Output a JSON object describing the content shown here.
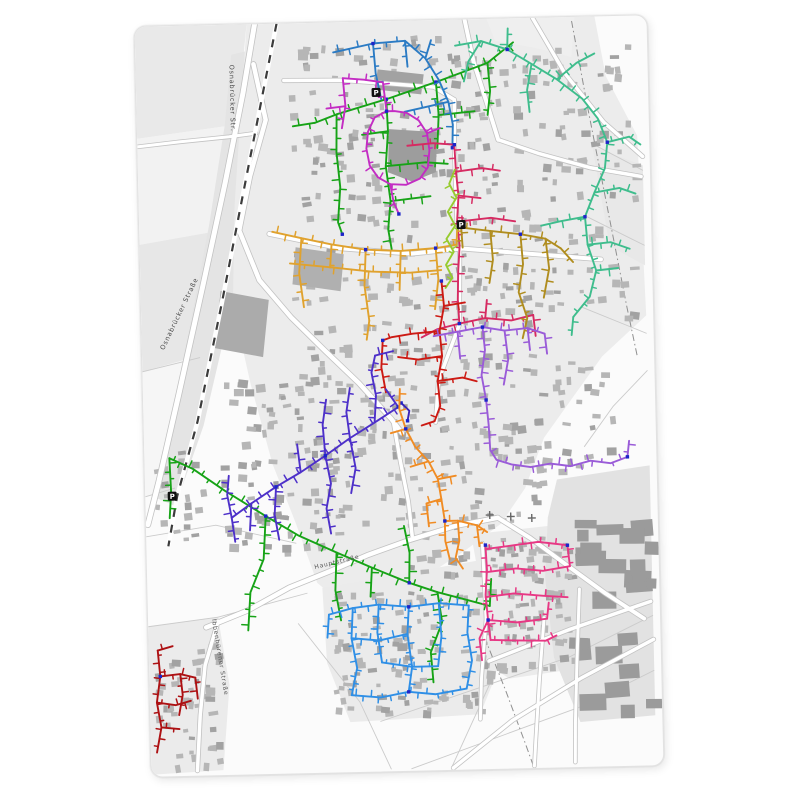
{
  "page": {
    "background": "#ffffff"
  },
  "panel": {
    "x": 142,
    "y": 20,
    "width": 512,
    "height": 750,
    "rotation_deg": -1.3,
    "corner_radius": 12,
    "background": "#fbfbfb",
    "border_color": "#e2e2e2"
  },
  "node_color": "#1d24c8",
  "street_labels": [
    {
      "text": "Osnabrücker Str.",
      "x": 94,
      "y": 40,
      "rotate": 90,
      "size": 6.5,
      "color": "#4a4a4a"
    },
    {
      "text": "Osnabrücker Straße",
      "x": 22,
      "y": 324,
      "rotate": -63,
      "size": 6.5,
      "color": "#4a4a4a"
    },
    {
      "text": "Hauptstraße",
      "x": 168,
      "y": 546,
      "rotate": -12,
      "size": 6,
      "color": "#555555"
    },
    {
      "text": "Ibbenbürener Straße",
      "x": 64,
      "y": 594,
      "rotate": 82,
      "size": 6,
      "color": "#555555"
    }
  ],
  "poi_icons": [
    {
      "type": "parking",
      "label": "P",
      "x": 240,
      "y": 71
    },
    {
      "type": "parking",
      "label": "P",
      "x": 322,
      "y": 205
    },
    {
      "type": "parking",
      "label": "P",
      "x": 27,
      "y": 470
    }
  ],
  "cemetery_crosses": [
    [
      344,
      496
    ],
    [
      365,
      498
    ],
    [
      386,
      500
    ]
  ],
  "base_map": {
    "fields": [
      {
        "fill": "#e9e9e9",
        "points": "0,0 112,0 100,100 0,112"
      },
      {
        "fill": "#f2f2f2",
        "points": "0,112 100,100 84,205 0,218"
      },
      {
        "fill": "#e7e7e7",
        "points": "0,218 84,205 58,330 0,345"
      },
      {
        "fill": "#f6f6f6",
        "points": "0,345 58,330 30,460 0,470"
      },
      {
        "fill": "#e4e4e4",
        "points": "96,30 142,20 120,140 96,260 60,400 30,480 8,470 40,340 70,200 88,100"
      },
      {
        "fill": "#ececec",
        "points": "112,0 460,0 470,60 500,120 505,300 460,340 430,380 400,420 380,470 355,505 320,530 280,555 240,575 205,590 170,560 150,500 128,440 108,360 92,280 96,180 104,90"
      },
      {
        "fill": "#ebebeb",
        "points": "175,565 340,540 360,600 345,660 330,695 200,700 178,640"
      },
      {
        "fill": "#ebebeb",
        "points": "325,515 440,505 448,580 440,650 360,660 330,640 332,560"
      },
      {
        "fill": "#e2e2e2",
        "points": "412,462 505,450 505,700 430,705 405,640 398,560 402,500"
      },
      {
        "fill": "#ebebeb",
        "points": "0,600 70,592 80,660 72,745 0,748"
      },
      {
        "fill": "#efefef",
        "points": "352,0 440,0 436,40 400,30 360,22"
      },
      {
        "fill": "#e8e8e8",
        "points": "455,130 505,150 505,250 470,230"
      }
    ],
    "parcel_lines": [
      {
        "points": "0,510 70,500 150,520"
      },
      {
        "points": "0,600 70,592"
      },
      {
        "points": "70,592 160,570"
      },
      {
        "points": "150,600 210,680 240,748"
      },
      {
        "points": "345,655 300,748"
      },
      {
        "points": "460,130 505,155"
      },
      {
        "points": "448,200 505,230"
      },
      {
        "points": "440,290 505,318"
      },
      {
        "points": "505,355 470,390 440,430"
      },
      {
        "points": "0,345 58,332"
      },
      {
        "points": "0,470 30,462"
      },
      {
        "points": "230,700 420,640 505,600"
      },
      {
        "points": "260,748 430,690 505,655"
      }
    ],
    "boundary_lines": [
      {
        "points": "437,4 451,90 468,188 486,292 495,340"
      },
      {
        "points": "336,618 356,672 374,724 382,748"
      }
    ],
    "roads": [
      {
        "points": "120,0 107,68 87,158 63,258 36,368 14,455 2,498",
        "width": 5
      },
      {
        "points": "118,40 129,96 112,152 100,206 119,256 150,294 184,329 216,361 248,398 258,412",
        "width": 4.5
      },
      {
        "points": "58,602 100,586 142,564 182,549 222,533 264,519 310,506 352,499",
        "width": 4.5
      },
      {
        "points": "352,499 384,520 420,548 458,577 496,603",
        "width": 4
      },
      {
        "points": "330,0 338,42 351,86 361,121",
        "width": 4
      },
      {
        "points": "361,121 402,136 452,151 503,161",
        "width": 3.5
      },
      {
        "points": "250,402 256,441 263,481 266,515",
        "width": 3.5
      },
      {
        "points": "130,210 200,226 272,233 322,229 362,233 422,239 461,243",
        "width": 4
      },
      {
        "points": "340,642 422,612 503,586",
        "width": 3.5
      },
      {
        "points": "302,748 362,702 432,661 505,624",
        "width": 3.5
      },
      {
        "points": "396,600 390,662 385,722 383,748",
        "width": 3
      },
      {
        "points": "432,572 428,642 425,705 424,745",
        "width": 3
      },
      {
        "points": "398,0 429,56 467,106 505,141",
        "width": 3.5
      },
      {
        "points": "0,120 42,116 92,112 119,109",
        "width": 3
      },
      {
        "points": "148,57 205,58 248,62 298,67 318,80",
        "width": 3.5
      },
      {
        "points": "318,80 317,128 318,205",
        "width": 3.5
      },
      {
        "points": "320,228 318,305 296,360 292,402",
        "width": 3.5
      },
      {
        "points": "336,524 338,600 332,660 330,700",
        "width": 3
      },
      {
        "points": "70,596 56,640 50,690 46,745",
        "width": 3.5
      }
    ],
    "railway": {
      "points": "142,0 127,68 105,168 81,278 54,396 32,470 22,520",
      "width": 4.5
    },
    "big_buildings": [
      {
        "fill": "#9d9d9d",
        "points": "252,108 300,112 298,152 274,161 250,151"
      },
      {
        "fill": "#a2a2a2",
        "points": "242,48 288,54 285,74 239,68"
      },
      {
        "fill": "#ababab",
        "points": "80,266 128,276 121,333 73,323"
      },
      {
        "fill": "#b0b0b0",
        "points": "156,224 204,232 200,269 152,261"
      }
    ],
    "building_clusters": [
      {
        "x": 150,
        "y": 15,
        "w": 200,
        "h": 190,
        "count": 130,
        "seed": 11
      },
      {
        "x": 315,
        "y": 25,
        "w": 180,
        "h": 290,
        "count": 140,
        "seed": 22
      },
      {
        "x": 150,
        "y": 210,
        "w": 195,
        "h": 190,
        "count": 110,
        "seed": 33
      },
      {
        "x": 75,
        "y": 350,
        "w": 180,
        "h": 175,
        "count": 130,
        "seed": 44
      },
      {
        "x": 245,
        "y": 400,
        "w": 150,
        "h": 155,
        "count": 80,
        "seed": 55
      },
      {
        "x": 180,
        "y": 570,
        "w": 160,
        "h": 120,
        "count": 95,
        "seed": 66
      },
      {
        "x": 333,
        "y": 518,
        "w": 92,
        "h": 132,
        "count": 75,
        "seed": 77
      },
      {
        "x": 5,
        "y": 618,
        "w": 65,
        "h": 122,
        "count": 45,
        "seed": 88
      },
      {
        "x": 352,
        "y": 330,
        "w": 118,
        "h": 135,
        "count": 45,
        "seed": 99
      },
      {
        "x": 8,
        "y": 425,
        "w": 50,
        "h": 90,
        "count": 20,
        "seed": 101
      },
      {
        "x": 420,
        "y": 470,
        "w": 80,
        "h": 220,
        "count": 26,
        "seed": 112,
        "industrial": true
      }
    ]
  },
  "networks": [
    {
      "name": "green-north",
      "color": "#17a317",
      "stubs": true,
      "stub_spacing": 9,
      "stub_len": 4.5,
      "paths": [
        "378,24 352,44 300,62 250,78 200,92 178,100",
        "200,92 199,130 202,165 199,200 203,212",
        "250,78 251,110 248,145 252,180 249,208 252,228",
        "251,110 225,113",
        "252,180 292,176",
        "248,145 288,142 310,144",
        "300,62 302,95 300,128",
        "302,95 338,92",
        "352,44 354,72 351,96",
        "178,100 156,103"
      ],
      "nodes": [
        [
          250,
          78
        ],
        [
          300,
          62
        ],
        [
          203,
          212
        ]
      ]
    },
    {
      "name": "green-south",
      "color": "#17a317",
      "stubs": true,
      "stub_spacing": 8,
      "stub_len": 4.5,
      "paths": [
        "25,432 48,443 80,466 120,492 152,512 190,530 225,546 262,562",
        "25,432 26,466 24,492",
        "120,492 117,535 103,568 100,606",
        "190,530 188,568 193,598",
        "262,562 263,532 258,505",
        "262,562 290,572 294,602 282,632 284,662",
        "290,572 318,580 342,587",
        "342,587 344,560",
        "225,546 223,575"
      ],
      "nodes": [
        [
          262,
          562
        ],
        [
          120,
          492
        ]
      ]
    },
    {
      "name": "steel-blue",
      "color": "#2b7bc4",
      "stubs": true,
      "stub_spacing": 9,
      "stub_len": 4.5,
      "paths": [
        "198,30 238,22 270,20 290,38 303,60 312,82 316,105 315,128",
        "238,22 240,52 245,78",
        "270,20 272,46",
        "290,38 296,20",
        "312,82 288,87 268,91"
      ],
      "nodes": [
        [
          315,
          128
        ],
        [
          238,
          22
        ]
      ]
    },
    {
      "name": "magenta",
      "color": "#c32cc3",
      "stubs": true,
      "stub_spacing": 10,
      "stub_len": 4,
      "paths": [
        "207,56 228,58 247,61 249,80 250,90",
        "250,90 238,96 231,110 229,127 232,144 240,156 252,163 268,164 282,158 290,147 292,130 290,113 282,100 270,92 258,90 250,90",
        "252,163 255,181 260,193",
        "207,56 209,84 205,106",
        "209,84 190,86",
        "290,113 303,108"
      ],
      "nodes": [
        [
          250,
          90
        ],
        [
          260,
          193
        ]
      ]
    },
    {
      "name": "teal",
      "color": "#3fbd8d",
      "stubs": true,
      "stub_spacing": 8,
      "stub_len": 4.5,
      "paths": [
        "320,26 346,22 372,31 396,46 421,62 446,82 461,102 470,126 467,152 456,176 446,200 448,228 456,254 449,280 432,300",
        "372,31 373,10",
        "396,46 391,72 393,94",
        "421,62 441,46 459,37",
        "470,126 492,121 503,129",
        "456,176 481,172 497,178",
        "448,228 471,226 490,233",
        "446,200 421,204 402,208",
        "456,254 478,252",
        "432,300 430,318",
        "346,22 333,42 328,62"
      ],
      "nodes": [
        [
          470,
          126
        ],
        [
          446,
          200
        ],
        [
          372,
          31
        ]
      ]
    },
    {
      "name": "crimson",
      "color": "#d62b62",
      "stubs": true,
      "stub_spacing": 9,
      "stub_len": 4,
      "paths": [
        "270,125 296,123 317,125",
        "317,125 318,152 320,176 318,202 320,226 318,252 317,280 318,304",
        "318,152 344,149 362,152",
        "320,176 342,179",
        "318,202 352,199 376,203",
        "318,304 344,299 370,302 392,297",
        "392,297 394,318",
        "318,304 296,309 280,317",
        "344,299 346,281"
      ],
      "nodes": [
        [
          317,
          125
        ],
        [
          318,
          304
        ]
      ]
    },
    {
      "name": "goldenrod",
      "color": "#e0a22e",
      "stubs": true,
      "stub_spacing": 8,
      "stub_len": 4.5,
      "paths": [
        "133,208 162,215 192,222 226,228 261,230 296,228 317,225",
        "150,240 192,245 231,250 270,252 301,250",
        "162,215 159,250 163,284",
        "226,228 224,264 228,299",
        "261,230 259,269",
        "296,228 298,259 294,289",
        "192,222 190,245",
        "317,225 318,208",
        "228,299 225,318"
      ],
      "nodes": [
        [
          226,
          228
        ],
        [
          296,
          228
        ]
      ]
    },
    {
      "name": "dark-khaki",
      "color": "#b08d1f",
      "stubs": true,
      "stub_spacing": 9,
      "stub_len": 4.5,
      "paths": [
        "322,208 351,212 381,216 406,221 421,231",
        "381,216 383,246 378,274 386,300 381,320",
        "406,221 409,251 403,280",
        "351,212 353,241 349,264",
        "421,231 433,245",
        "322,208 323,228"
      ],
      "nodes": [
        [
          381,
          216
        ]
      ]
    },
    {
      "name": "yellow-green",
      "color": "#97cb2f",
      "stubs": true,
      "stub_spacing": 11,
      "stub_len": 3.5,
      "paths": [
        "317,150 311,164 318,178 309,192 316,206 307,219 314,232 306,245 312,258 305,268"
      ],
      "nodes": []
    },
    {
      "name": "red",
      "color": "#cc1a13",
      "stubs": true,
      "stub_spacing": 9,
      "stub_len": 4.5,
      "paths": [
        "301,261 303,286 298,311 300,336 295,361 297,386 291,401",
        "298,311 271,313 250,316 241,319",
        "300,336 276,339 256,336",
        "295,361 320,358 334,362",
        "303,286 324,283",
        "241,319 239,346 243,371",
        "291,401 278,405"
      ],
      "nodes": [
        [
          301,
          261
        ],
        [
          241,
          319
        ]
      ]
    },
    {
      "name": "indigo-connector",
      "color": "#3a23b8",
      "stubs": false,
      "paths": [
        "258,382 266,390 264,400"
      ],
      "nodes": [
        [
          258,
          382
        ],
        [
          264,
          400
        ]
      ]
    },
    {
      "name": "blue-violet",
      "color": "#4d30c9",
      "stubs": true,
      "stub_spacing": 8,
      "stub_len": 4.5,
      "paths": [
        "255,386 231,401 206,416 181,433 156,449 131,463 106,479 86,493",
        "231,401 233,374 229,351 233,334",
        "206,416 203,390 207,366",
        "181,433 179,402 183,377",
        "156,449 153,421",
        "131,463 129,491 133,516",
        "106,479 104,506",
        "86,493 82,470 84,451",
        "86,493 89,517",
        "181,433 186,461 181,486 185,511",
        "206,416 211,446 206,471",
        "233,334 251,330",
        "255,386 243,368"
      ],
      "nodes": [
        [
          255,
          386
        ],
        [
          181,
          433
        ],
        [
          131,
          463
        ]
      ]
    },
    {
      "name": "medium-purple",
      "color": "#9a5cd8",
      "stubs": true,
      "stub_spacing": 8,
      "stub_len": 4.5,
      "paths": [
        "292,316 316,312 341,308 363,312",
        "341,308 343,331 339,356 343,381",
        "363,312 366,341 361,366",
        "316,312 318,339",
        "363,312 386,310 403,316",
        "386,310 388,332",
        "343,381 345,406 346,431 352,441 367,446 386,449 406,446 426,449 446,444 466,447 483,441",
        "483,441 485,425",
        "403,316 405,336"
      ],
      "nodes": [
        [
          343,
          381
        ],
        [
          483,
          441
        ],
        [
          341,
          308
        ]
      ]
    },
    {
      "name": "orange",
      "color": "#f08c24",
      "stubs": true,
      "stub_spacing": 8,
      "stub_len": 4.5,
      "paths": [
        "257,368 256,388 262,408 271,426 284,441 293,459 296,479 299,501",
        "296,479 281,483 283,506",
        "299,501 299,521 303,539",
        "299,501 312,501 313,521 309,538 316,549",
        "312,501 331,506 341,513",
        "331,506 333,527",
        "284,441 266,446",
        "262,408 247,412",
        "293,459 311,456"
      ],
      "nodes": [
        [
          262,
          408
        ],
        [
          299,
          501
        ]
      ]
    },
    {
      "name": "dodger-blue",
      "color": "#2f8fe6",
      "stubs": true,
      "stub_spacing": 7,
      "stub_len": 4,
      "paths": [
        "181,592 205,586 231,583 261,586 291,583 321,586",
        "205,586 203,616 208,646 202,673",
        "231,583 229,611 233,641",
        "261,586 259,613 263,646 259,671",
        "291,583 293,616 289,646",
        "321,586 319,613 323,641 317,669",
        "203,616 231,619 259,613",
        "233,641 263,646 289,646",
        "202,673 231,676 259,671 286,674 317,669",
        "181,592 179,615"
      ],
      "nodes": [
        [
          261,
          586
        ],
        [
          259,
          671
        ]
      ]
    },
    {
      "name": "deep-pink",
      "color": "#e73884",
      "stubs": true,
      "stub_spacing": 7,
      "stub_len": 4,
      "paths": [
        "339,526 340,551 338,576 340,601",
        "339,530 366,527 392,524 421,528",
        "340,553 369,550 396,553 423,549",
        "421,528 423,549",
        "338,578 366,575 396,578 420,580",
        "340,601 369,604 399,601",
        "340,601 331,619 333,641",
        "342,621 367,622 397,623 408,618",
        "340,601 342,621",
        "399,601 401,585"
      ],
      "nodes": [
        [
          339,
          526
        ],
        [
          340,
          601
        ],
        [
          421,
          528
        ]
      ]
    },
    {
      "name": "dark-red",
      "color": "#ad1113",
      "stubs": true,
      "stub_spacing": 8,
      "stub_len": 4,
      "paths": [
        "9,624 11,650 7,676 11,701 6,726",
        "11,650 31,648 46,652",
        "7,676 26,679 41,675",
        "11,701 29,703",
        "31,648 33,669 29,689",
        "46,652 48,673",
        "9,624 24,620"
      ],
      "nodes": [
        [
          11,
          650
        ]
      ]
    }
  ]
}
